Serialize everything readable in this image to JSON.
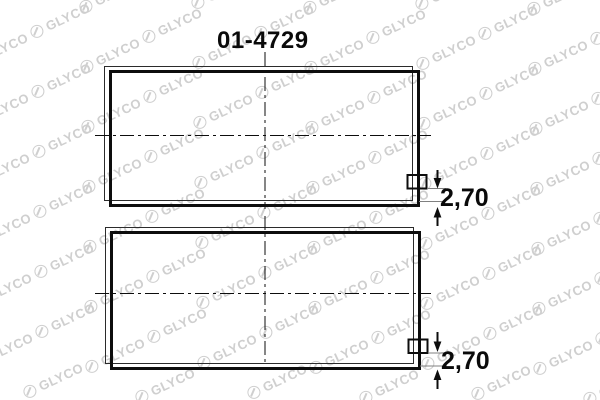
{
  "drawing": {
    "part_number": "01-4729",
    "bearings": [
      {
        "name": "upper-shell",
        "thickness_label": "2,70"
      },
      {
        "name": "lower-shell",
        "thickness_label": "2,70"
      }
    ]
  },
  "watermark": {
    "text": "GLYCO",
    "logo": "circle-g-icon",
    "color": "#cfcfcf"
  },
  "colors": {
    "line": "#0d0d0d",
    "back_line": "#2b2b2b",
    "ext_line": "#808080",
    "background": "#ffffff"
  }
}
